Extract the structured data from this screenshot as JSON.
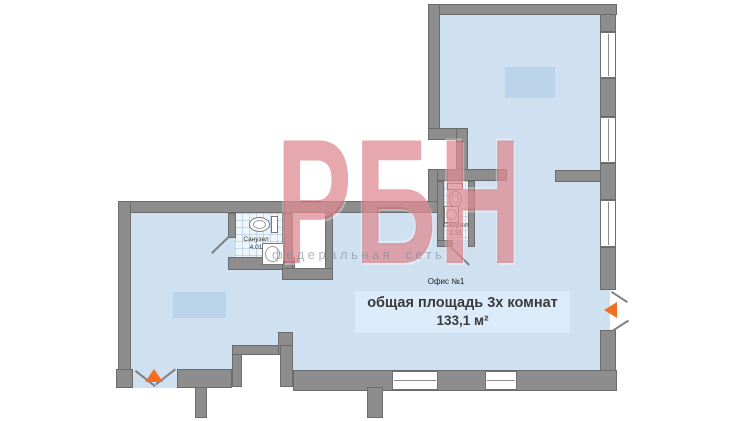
{
  "watermark": {
    "brand": "РБН",
    "subtitle": "федеральная сеть"
  },
  "unit": {
    "office_label": "Офис №1",
    "area_title": "общая площадь 3х комнат",
    "area_value": "133,1 м²"
  },
  "bathrooms": [
    {
      "name": "Санузел",
      "area": "4.01"
    },
    {
      "name": "Санузел",
      "area": "2.51"
    }
  ],
  "colors": {
    "floor": "#cfe1f1",
    "wall": "#8d8d8d",
    "wall_border": "#6b6b6b",
    "highlight": "#bcd4ea",
    "info_box": "#dcebf9",
    "tile": "#eef5fb",
    "arrow": "#f26f21",
    "watermark_red": "rgba(198,48,60,0.42)",
    "watermark_gray": "rgba(125,135,148,0.6)",
    "text": "#3a3a3a"
  }
}
